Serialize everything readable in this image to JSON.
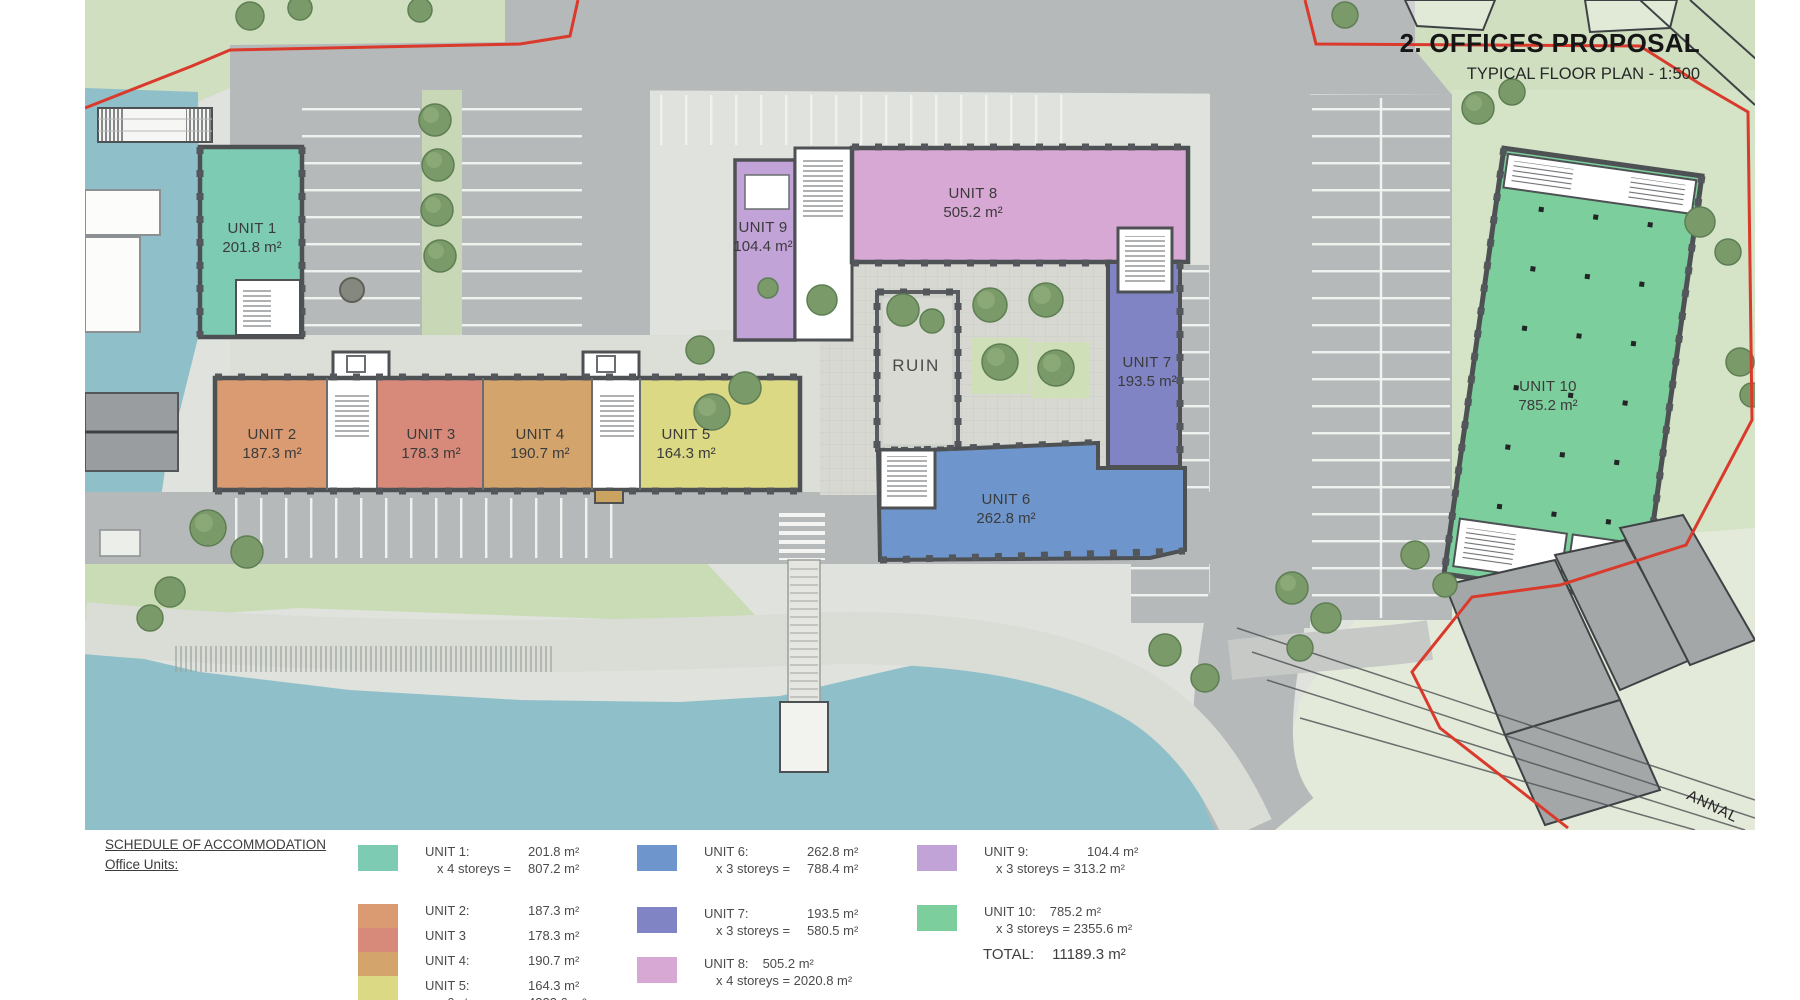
{
  "title": {
    "heading": "2. OFFICES PROPOSAL",
    "subheading": "TYPICAL FLOOR PLAN - 1:500"
  },
  "colors": {
    "unit1": "#7ccbb2",
    "unit2": "#db9b72",
    "unit3": "#d88a7a",
    "unit4": "#d3a56d",
    "unit5": "#dcd985",
    "unit6": "#6e96cc",
    "unit7": "#8084c4",
    "unit8": "#d8a8d5",
    "unit9": "#c2a3d8",
    "unit10": "#7cce9c",
    "water": "#8fc0c9",
    "boundary": "#d93a2b"
  },
  "plan": {
    "units": [
      {
        "name": "UNIT 1",
        "area": "201.8 m²"
      },
      {
        "name": "UNIT 2",
        "area": "187.3 m²"
      },
      {
        "name": "UNIT 3",
        "area": "178.3 m²"
      },
      {
        "name": "UNIT 4",
        "area": "190.7 m²"
      },
      {
        "name": "UNIT 5",
        "area": "164.3 m²"
      },
      {
        "name": "UNIT 6",
        "area": "262.8 m²"
      },
      {
        "name": "UNIT 7",
        "area": "193.5 m²"
      },
      {
        "name": "UNIT 8",
        "area": "505.2 m²"
      },
      {
        "name": "UNIT 9",
        "area": "104.4 m²"
      },
      {
        "name": "UNIT 10",
        "area": "785.2 m²"
      }
    ],
    "ruin_label": "RUIN",
    "street_label": "ANNAL"
  },
  "legend": {
    "heading1": "SCHEDULE OF ACCOMMODATION",
    "heading2": "Office Units:",
    "u1": {
      "label": "UNIT 1:",
      "value": "201.8 m²",
      "calc": "x 4 storeys =",
      "calcv": "807.2 m²"
    },
    "u2": {
      "label": "UNIT 2:",
      "value": "187.3 m²"
    },
    "u3": {
      "label": "UNIT 3",
      "value": "178.3 m²"
    },
    "u4": {
      "label": "UNIT 4:",
      "value": "190.7 m²"
    },
    "u5": {
      "label": "UNIT 5:",
      "value": "164.3 m²",
      "calc": "x 6 storeys =",
      "calcv": "4323.6 m²"
    },
    "u6": {
      "label": "UNIT 6:",
      "value": "262.8 m²",
      "calc": "x 3 storeys =",
      "calcv": "788.4 m²"
    },
    "u7": {
      "label": "UNIT 7:",
      "value": "193.5 m²",
      "calc": "x 3 storeys =",
      "calcv": "580.5 m²"
    },
    "u8": {
      "label": "UNIT 8:",
      "value": "505.2 m²",
      "calc": "x 4 storeys = 2020.8 m²"
    },
    "u9": {
      "label": "UNIT 9:",
      "value": "104.4 m²",
      "calc": "x 3 storeys = 313.2 m²"
    },
    "u10": {
      "label": "UNIT 10:",
      "value": "785.2 m²",
      "calc": "x 3 storeys = 2355.6 m²"
    },
    "total_label": "TOTAL:",
    "total_value": "11189.3 m²"
  }
}
